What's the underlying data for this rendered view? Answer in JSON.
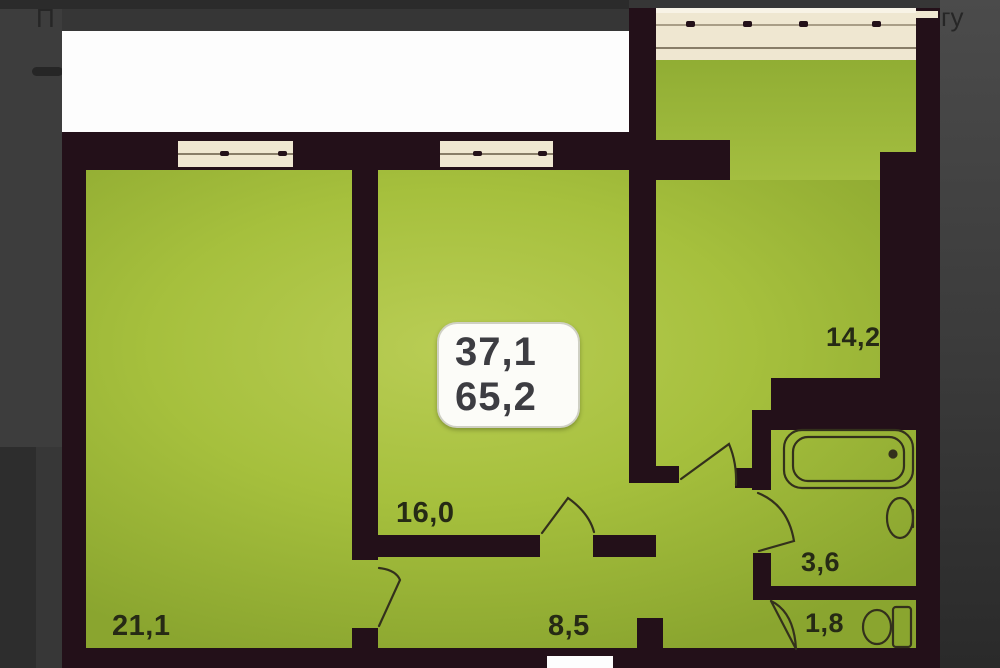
{
  "page": {
    "title_fragment_left": "П",
    "title_fragment_right": "гу"
  },
  "floorplan": {
    "area_badge": {
      "upper": "37,1",
      "lower": "65,2"
    },
    "rooms": [
      {
        "id": "room-21-1",
        "area_label": "21,1"
      },
      {
        "id": "room-16-0",
        "area_label": "16,0"
      },
      {
        "id": "room-14-2",
        "area_label": "14,2"
      },
      {
        "id": "hallway-8-5",
        "area_label": "8,5"
      },
      {
        "id": "bathroom-3-6",
        "area_label": "3,6"
      },
      {
        "id": "wc-1-8",
        "area_label": "1,8"
      }
    ],
    "fixtures": [
      "bathtub",
      "sink",
      "toilet"
    ],
    "symbols": [
      "window",
      "balcony-window",
      "door-swing"
    ]
  },
  "colors": {
    "bg_base": "#363636",
    "bg_top_strip": "#2b2b2b",
    "bg_right_from": "#4b4b4b",
    "bg_right_mid": "#3a3a3a",
    "bg_right_to": "#2a2a2a",
    "bg_left_upper": "#3d3d3d",
    "bg_left_lower": "#2d2d2d",
    "bg_left_lower_in": "#373737",
    "title_text": "#262626",
    "white": "#fdfdfd",
    "wall": "#231019",
    "green_light": "#b9cd55",
    "green_mid": "#a6c03d",
    "green_dark": "#8aa52f",
    "balcony_green_top": "#8fac33",
    "balcony_green_bot": "#a4be40",
    "window_cream": "#efe7d1",
    "window_white": "#f8f3e6",
    "window_line": "#887d68",
    "window_line2": "#a99e87",
    "badge_bg": "#fcfcf8",
    "badge_border": "#cfd0c4",
    "badge_text": "#3d3d42",
    "label_text": "#262a15",
    "arc_line": "#33301c"
  }
}
